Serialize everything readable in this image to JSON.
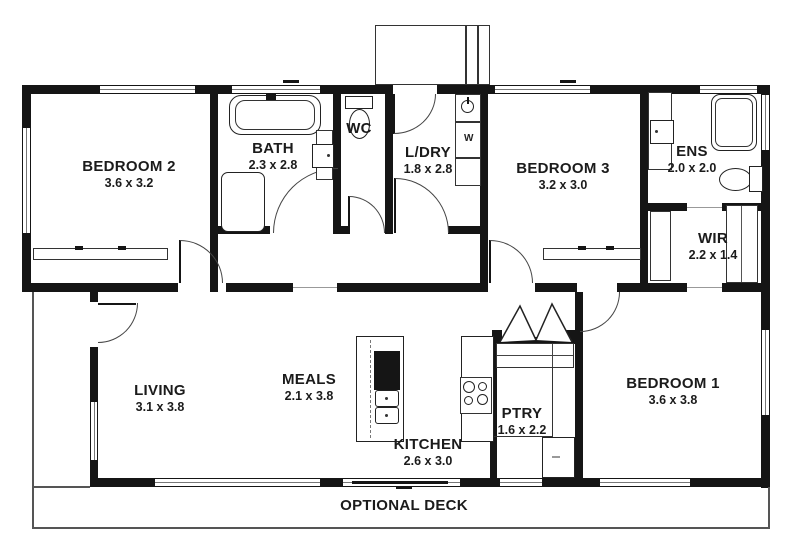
{
  "rooms": [
    {
      "name": "BEDROOM 2",
      "dims": "3.6 x 3.2"
    },
    {
      "name": "BATH",
      "dims": "2.3 x 2.8"
    },
    {
      "name": "WC",
      "dims": ""
    },
    {
      "name": "L/DRY",
      "dims": "1.8 x 2.8"
    },
    {
      "name": "BEDROOM 3",
      "dims": "3.2 x 3.0"
    },
    {
      "name": "ENS",
      "dims": "2.0 x 2.0"
    },
    {
      "name": "WIR",
      "dims": "2.2 x 1.4"
    },
    {
      "name": "LIVING",
      "dims": "3.1 x 3.8"
    },
    {
      "name": "MEALS",
      "dims": "2.1 x 3.8"
    },
    {
      "name": "KITCHEN",
      "dims": "2.6 x 3.0"
    },
    {
      "name": "PTRY",
      "dims": "1.6 x 2.2"
    },
    {
      "name": "BEDROOM 1",
      "dims": "3.6 x 3.8"
    },
    {
      "name": "OPTIONAL DECK",
      "dims": ""
    }
  ],
  "fixtures": {
    "washer_label": "W"
  },
  "colors": {
    "wall": "#151515",
    "door_arc": "#444444",
    "text": "#1b1b1b"
  }
}
